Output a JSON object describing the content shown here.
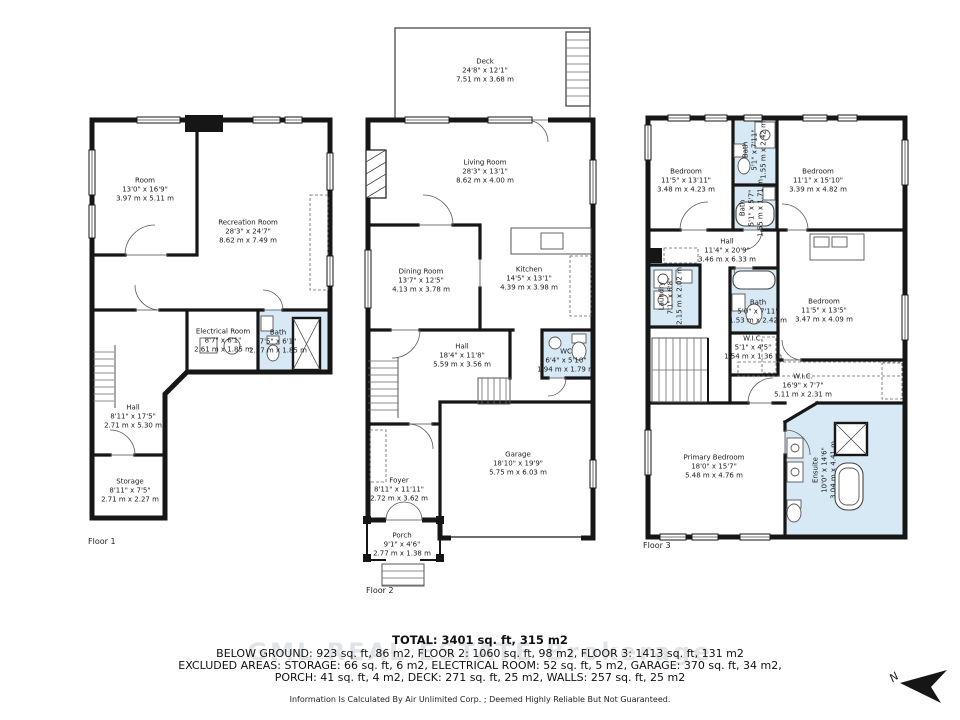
{
  "colors": {
    "wall": "#161616",
    "bath_fill": "#d6e9f4"
  },
  "floors": [
    {
      "label": "Floor 1",
      "rooms": [
        {
          "name": "Room",
          "ft": "13'0\" x 16'9\"",
          "m": "3.97 m x 5.11 m"
        },
        {
          "name": "Recreation Room",
          "ft": "28'3\" x 24'7\"",
          "m": "8.62 m x 7.49 m"
        },
        {
          "name": "Electrical Room",
          "ft": "8'7\" x 6'1\"",
          "m": "2.61 m x 1.85 m"
        },
        {
          "name": "Bath",
          "ft": "7'5\" x 6'1\"",
          "m": "2.27 m x 1.85 m"
        },
        {
          "name": "Hall",
          "ft": "8'11\" x 17'5\"",
          "m": "2.71 m x 5.30 m"
        },
        {
          "name": "Storage",
          "ft": "8'11\" x 7'5\"",
          "m": "2.71 m x 2.27 m"
        }
      ]
    },
    {
      "label": "Floor 2",
      "rooms": [
        {
          "name": "Deck",
          "ft": "24'8\" x 12'1\"",
          "m": "7.51 m x 3.68 m"
        },
        {
          "name": "Living Room",
          "ft": "28'3\" x 13'1\"",
          "m": "8.62 m x 4.00 m"
        },
        {
          "name": "Dining Room",
          "ft": "13'7\" x 12'5\"",
          "m": "4.13 m x 3.78 m"
        },
        {
          "name": "Kitchen",
          "ft": "14'5\" x 13'1\"",
          "m": "4.39 m x 3.98 m"
        },
        {
          "name": "Hall",
          "ft": "18'4\" x 11'8\"",
          "m": "5.59 m x 3.56 m"
        },
        {
          "name": "WC",
          "ft": "6'4\" x 5'10\"",
          "m": "1.94 m x 1.79 m"
        },
        {
          "name": "Garage",
          "ft": "18'10\" x 19'9\"",
          "m": "5.75 m x 6.03 m"
        },
        {
          "name": "Foyer",
          "ft": "8'11\" x 11'11\"",
          "m": "2.72 m x 3.62 m"
        },
        {
          "name": "Porch",
          "ft": "9'1\" x 4'6\"",
          "m": "2.77 m x 1.38 m"
        }
      ]
    },
    {
      "label": "Floor 3",
      "rooms": [
        {
          "name": "Bedroom",
          "ft": "11'5\" x 13'11\"",
          "m": "3.48 m x 4.23 m"
        },
        {
          "name": "Bath",
          "ft": "5'1\" x 7'11\"",
          "m": "1.55 m x 2.42 m"
        },
        {
          "name": "Bedroom",
          "ft": "11'1\" x 15'10\"",
          "m": "3.39 m x 4.82 m"
        },
        {
          "name": "Bath",
          "ft": "5'1\" x 5'7\"",
          "m": "1.55 m x 1.71 m"
        },
        {
          "name": "Hall",
          "ft": "11'4\" x 20'9\"",
          "m": "3.46 m x 6.33 m"
        },
        {
          "name": "Laundry",
          "ft": "7'1\" x 6'8\"",
          "m": "2.15 m x 2.02 m"
        },
        {
          "name": "Bath",
          "ft": "5'0\" x 7'11\"",
          "m": "1.53 m x 2.42 m"
        },
        {
          "name": "W.I.C.",
          "ft": "5'1\" x 4'5\"",
          "m": "1.54 m x 1.36 m"
        },
        {
          "name": "Bedroom",
          "ft": "11'5\" x 13'5\"",
          "m": "3.47 m x 4.09 m"
        },
        {
          "name": "W.I.C.",
          "ft": "16'9\" x 7'7\"",
          "m": "5.11 m x 2.31 m"
        },
        {
          "name": "Primary Bedroom",
          "ft": "18'0\" x 15'7\"",
          "m": "5.48 m x 4.76 m"
        },
        {
          "name": "Ensuite",
          "ft": "10'0\" x 14'6\"",
          "m": "3.04 m x 4.41 m"
        }
      ]
    }
  ],
  "summary": {
    "total": "TOTAL: 3401 sq. ft, 315 m2",
    "line2": "BELOW GROUND: 923 sq. ft, 86 m2, FLOOR 2: 1060 sq. ft, 98 m2, FLOOR 3: 1413 sq. ft, 131 m2",
    "line3": "EXCLUDED AREAS: STORAGE: 66 sq. ft, 6 m2, ELECTRICAL ROOM: 52 sq. ft, 5 m2, GARAGE: 370 sq. ft, 34 m2,",
    "line4": "PORCH: 41 sq. ft, 4 m2, DECK: 271 sq. ft, 25 m2, WALLS: 257 sq. ft, 25 m2",
    "disclaimer": "Information Is Calculated By Air Unlimited Corp. ; Deemed Highly Reliable But Not Guaranteed."
  },
  "watermark": "GML REAL ESTATE Brokerage",
  "compass": {
    "label": "N"
  }
}
